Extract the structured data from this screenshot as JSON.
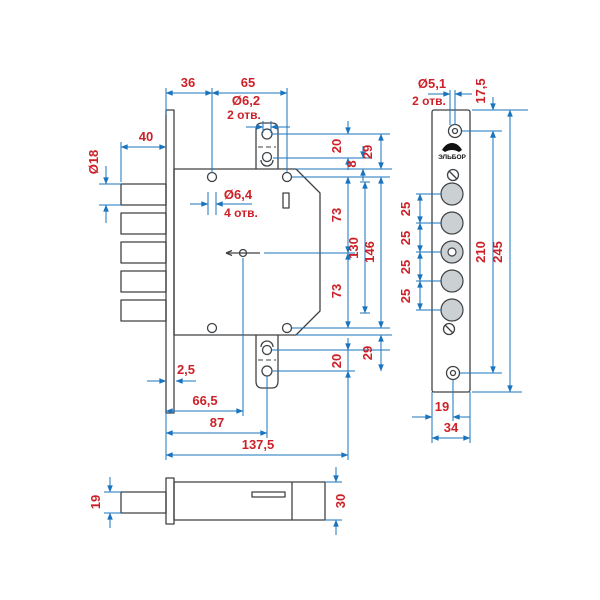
{
  "colors": {
    "dimension_line": "#1a74bd",
    "dimension_text": "#cc2128",
    "outline": "#3f4245",
    "hole_fill": "#cbd0d3"
  },
  "views": {
    "front": {
      "dims": {
        "w36": "36",
        "w65": "65",
        "w40": "40",
        "dia18": "Ø18",
        "dia62": "Ø6,2",
        "dia62_count": "2 отв.",
        "dia64": "Ø6,4",
        "dia64_count": "4 отв.",
        "pitch20_top": "20",
        "edge8": "8",
        "total29_top": "29",
        "half73_top": "73",
        "span130": "130",
        "span146": "146",
        "half73_bottom": "73",
        "pitch20_bottom": "20",
        "total29_bottom": "29",
        "thickness25": "2,5",
        "keyhole665": "66,5",
        "strap87": "87",
        "length1375": "137,5"
      }
    },
    "plate": {
      "logo": "ЭЛЬБОР",
      "dims": {
        "dia51": "Ø5,1",
        "dia51_count": "2 отв.",
        "top175": "17,5",
        "pitch25": "25",
        "span210": "210",
        "span245": "245",
        "hole19": "19",
        "width34": "34"
      }
    },
    "side": {
      "dims": {
        "bolt19": "19",
        "height30": "30"
      }
    }
  }
}
